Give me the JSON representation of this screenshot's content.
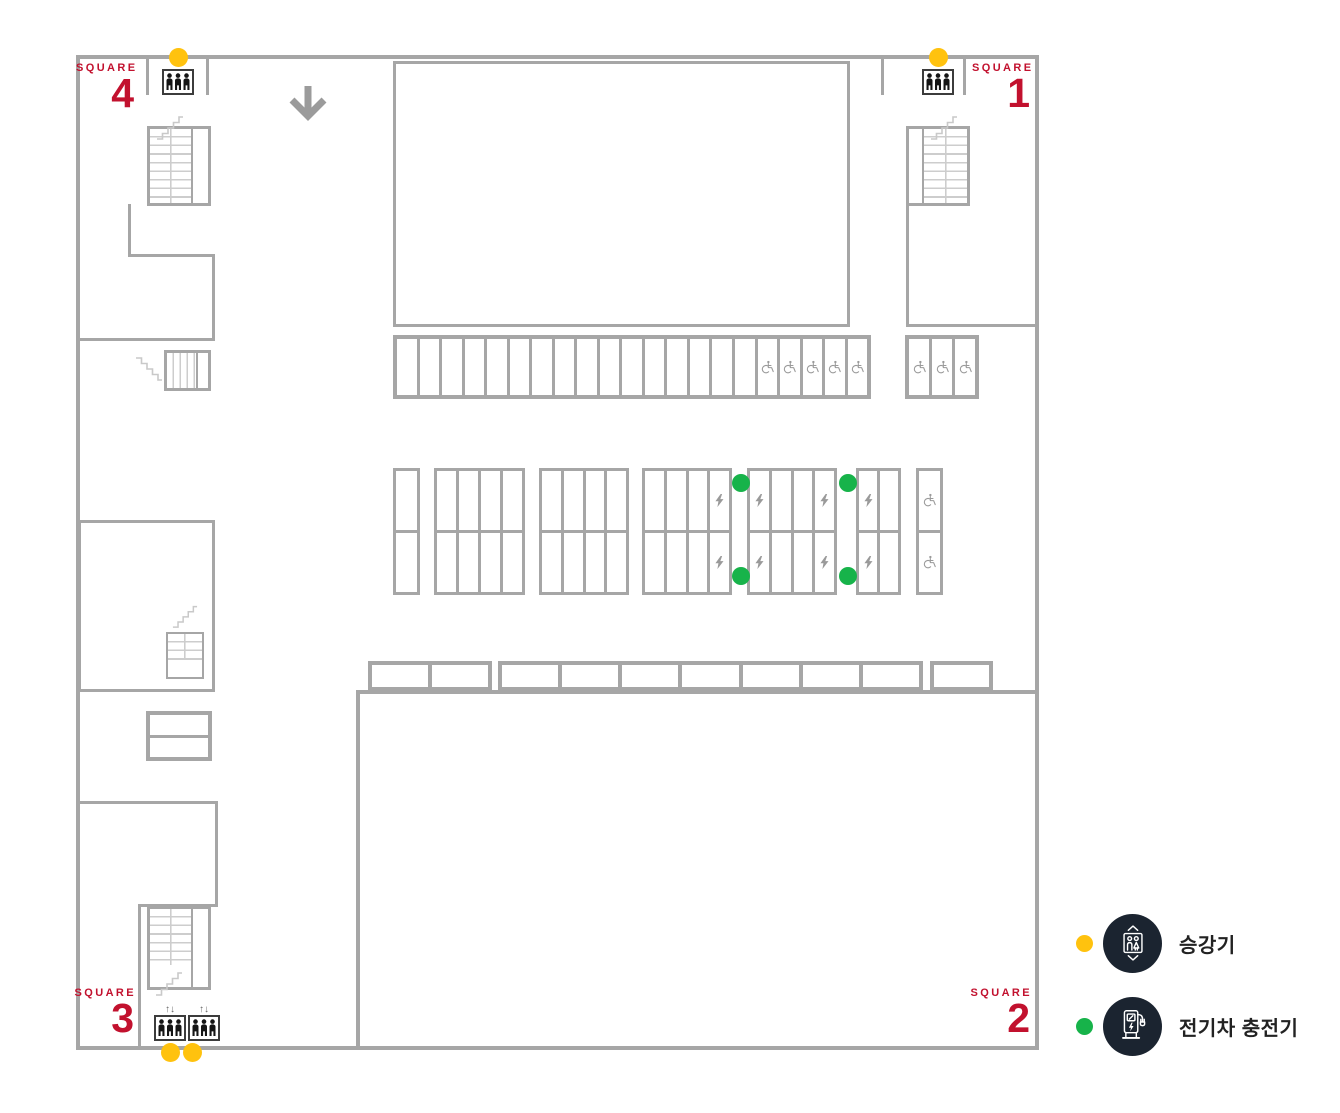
{
  "plan": {
    "colors": {
      "wall": "#A6A6A6",
      "wall_light": "#CDCDCD",
      "icon_gray": "#9A9A9A",
      "accent_red": "#C2112E",
      "dot_yellow": "#FFC20E",
      "dot_green": "#17B34A",
      "legend_bg": "#1B2430"
    },
    "squares": [
      {
        "word": "SQUARE",
        "number": "1"
      },
      {
        "word": "SQUARE",
        "number": "2"
      },
      {
        "word": "SQUARE",
        "number": "3"
      },
      {
        "word": "SQUARE",
        "number": "4"
      }
    ],
    "elevator_updown": "↑↓",
    "parking": {
      "top_row": {
        "cells": 21,
        "rows": 1,
        "accessible_last": 5
      },
      "top_right_block": {
        "cells": 3,
        "rows": 1,
        "accessible_all": true
      },
      "mid_a": {
        "cells": 1,
        "rows": 2
      },
      "mid_b": {
        "cells": 4,
        "rows": 2
      },
      "mid_c": {
        "cells": 4,
        "rows": 2
      },
      "mid_d": {
        "cells": 4,
        "rows": 2,
        "ev_cols": [
          4
        ]
      },
      "mid_e": {
        "cells": 4,
        "rows": 2,
        "ev_cols": [
          1,
          4
        ]
      },
      "mid_f": {
        "cells": 2,
        "rows": 2,
        "ev_cols": [
          1
        ]
      },
      "mid_g": {
        "cells": 1,
        "rows": 2,
        "accessible_all": true
      },
      "strip_a": {
        "cells": 2,
        "rows": 1
      },
      "strip_b": {
        "cells": 7,
        "rows": 1
      },
      "strip_c": {
        "cells": 1,
        "rows": 1
      }
    },
    "legend": {
      "items": [
        {
          "label": "승강기",
          "icon": "elevator",
          "dot_color": "#FFC20E"
        },
        {
          "label": "전기차 충전기",
          "icon": "ev-charger",
          "dot_color": "#17B34A"
        }
      ]
    }
  }
}
